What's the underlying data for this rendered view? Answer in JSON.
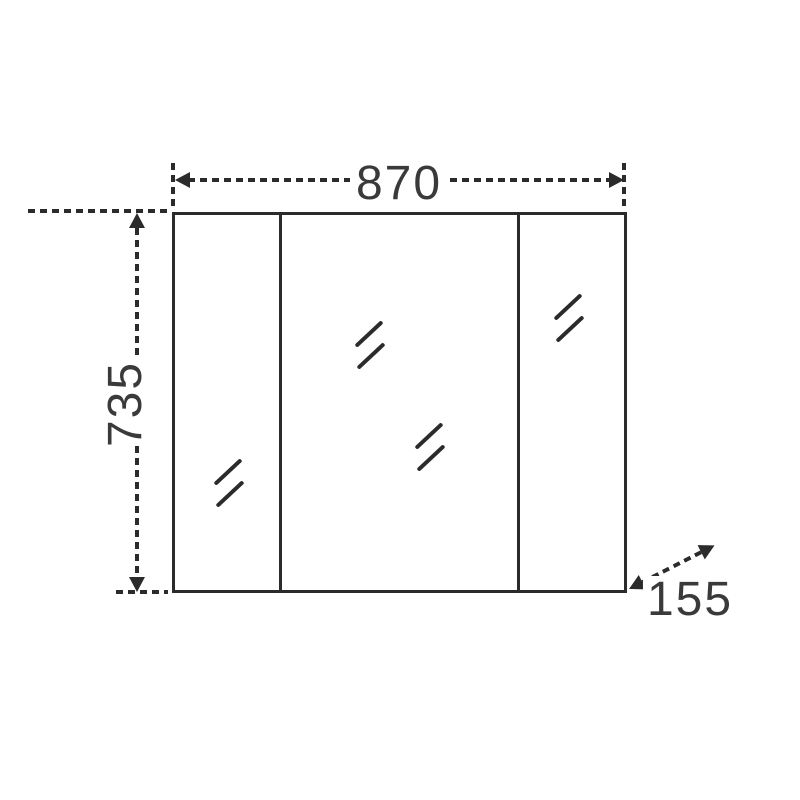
{
  "figure": {
    "kind": "technical dimension drawing",
    "subject": "three-door mirror cabinet, front elevation"
  },
  "dimensions": {
    "width": {
      "value": "870",
      "orientation": "horizontal",
      "position": "top"
    },
    "height": {
      "value": "735",
      "orientation": "vertical",
      "position": "left"
    },
    "depth": {
      "value": "155",
      "orientation": "diagonal",
      "position": "bottom-right"
    }
  },
  "cabinet": {
    "panel_count": 3,
    "mirror_shine_marks": 4
  },
  "colors": {
    "line": "#2b2b2b",
    "text": "#3a3a3a",
    "background": "#ffffff"
  }
}
